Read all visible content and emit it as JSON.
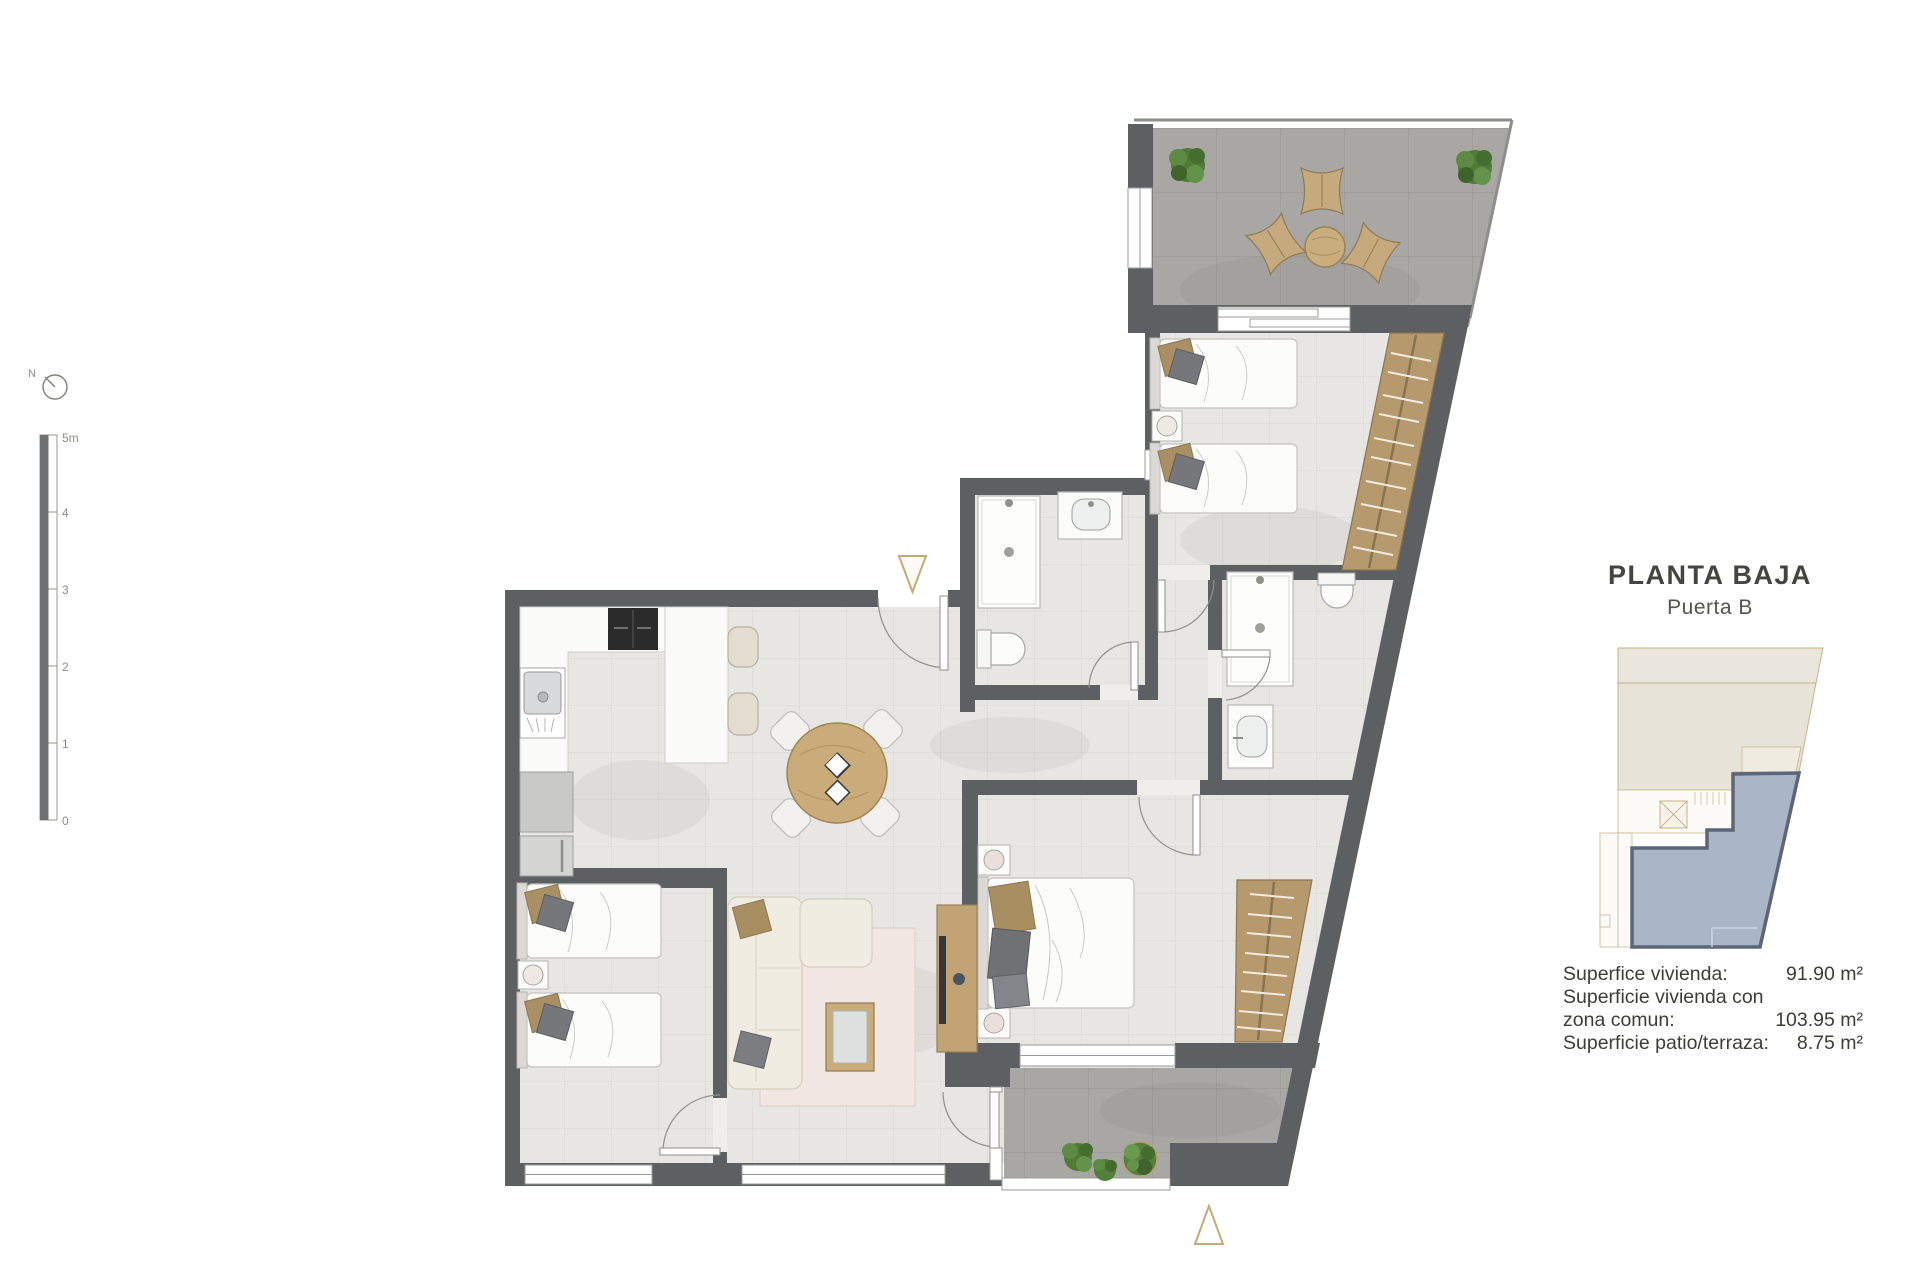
{
  "compass": {
    "north_label": "N"
  },
  "scale_bar": {
    "labels": [
      "5m",
      "4",
      "3",
      "2",
      "1",
      "0"
    ]
  },
  "title_block": {
    "title": "PLANTA BAJA",
    "subtitle": "Puerta B"
  },
  "areas": {
    "row1_label": "Superfice vivienda:",
    "row1_value": "91.90 m²",
    "row2_label_line1": "Superficie vivienda con",
    "row2_label_line2": "zona comun:",
    "row2_value": "103.95 m²",
    "row3_label": "Superficie patio/terraza:",
    "row3_value": "8.75 m²"
  },
  "colors": {
    "wall": "#5d6063",
    "interior_floor": "#e7e6e3",
    "outdoor_floor": "#a8a7a3",
    "wood_accent": "#c9ac7a",
    "wardrobe_tan": "#b69a6e",
    "marker_outline": "#c3ab76",
    "unit_highlight_fill": "#aab5c8",
    "unit_highlight_stroke": "#5d6678",
    "minimap_beige": "#eae6dd"
  }
}
